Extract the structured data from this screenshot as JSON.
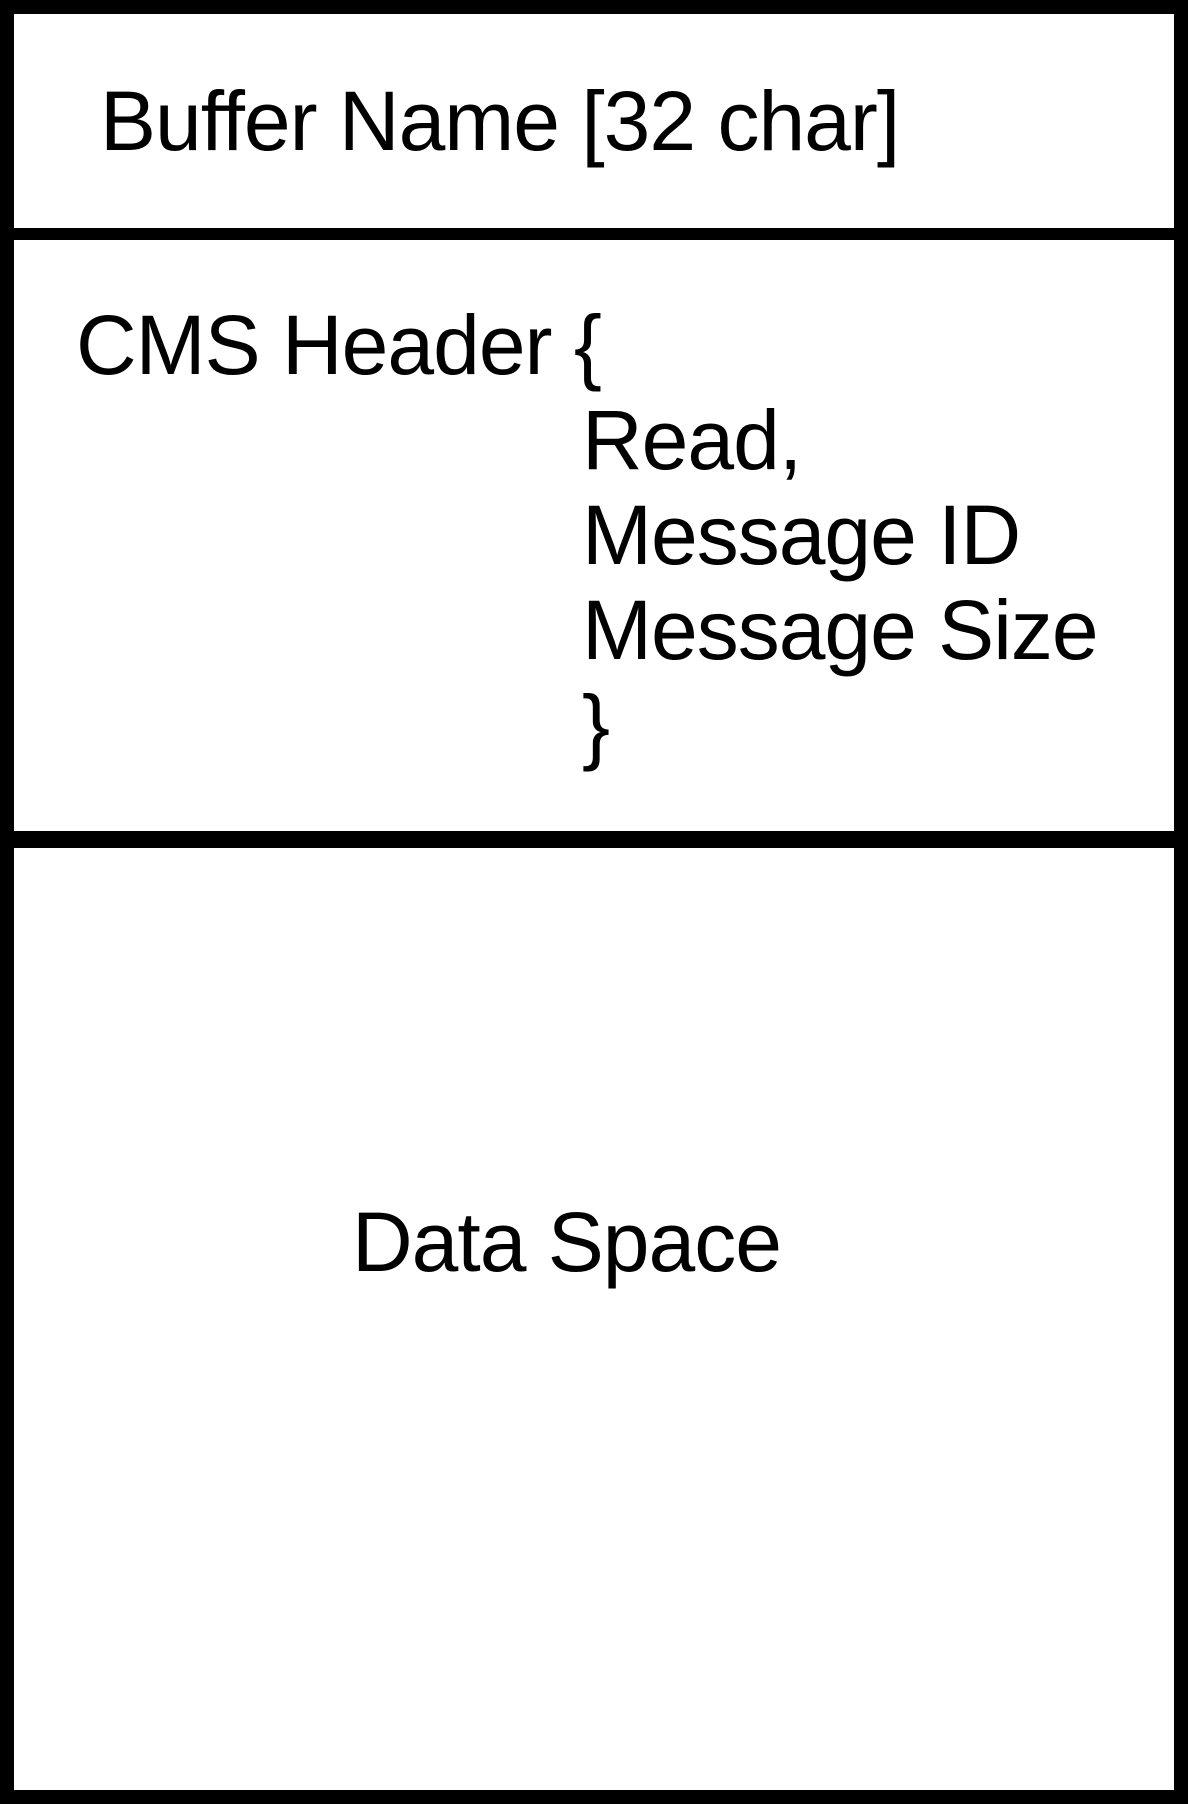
{
  "diagram": {
    "kind": "buffer-memory-layout",
    "colors": {
      "border": "#000000",
      "background": "#ffffff",
      "text": "#000000"
    },
    "sections": [
      {
        "id": "buffer-name",
        "label": "Buffer Name [32 char]"
      },
      {
        "id": "cms-header",
        "open": "CMS Header {",
        "fields": [
          "Read,",
          "Message ID",
          "Message Size"
        ],
        "close": "}"
      },
      {
        "id": "data-space",
        "label": "Data Space"
      }
    ]
  }
}
